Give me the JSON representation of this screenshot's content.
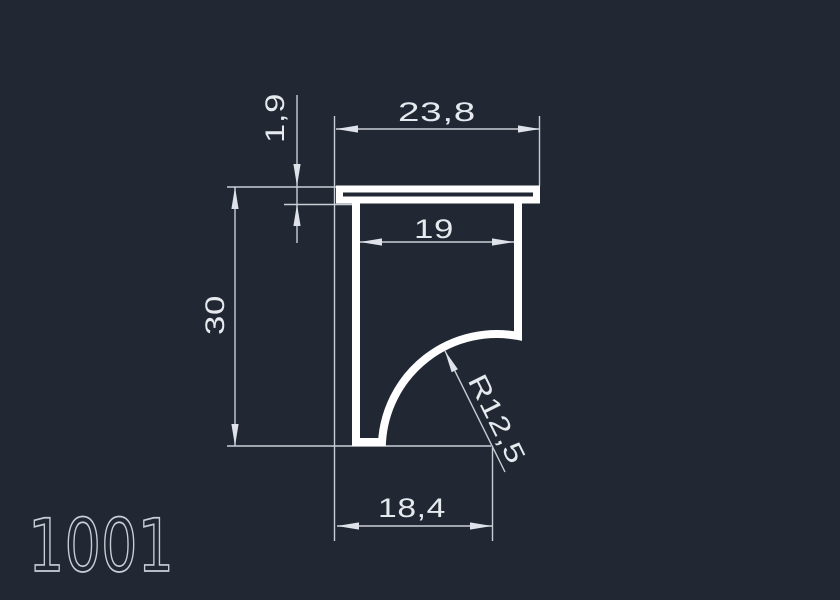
{
  "drawing": {
    "title": "1001",
    "type": "profile-cross-section",
    "colors": {
      "background": "#212833",
      "profile_line": "#ffffff",
      "dimension_line": "#c9ced6",
      "dimension_text": "#e6e9ee"
    }
  },
  "dimensions": {
    "flange_width": "23,8",
    "flange_thickness": "1,9",
    "inner_width": "19",
    "overall_height": "30",
    "bottom_width": "18,4",
    "fillet_radius": "R12,5"
  }
}
